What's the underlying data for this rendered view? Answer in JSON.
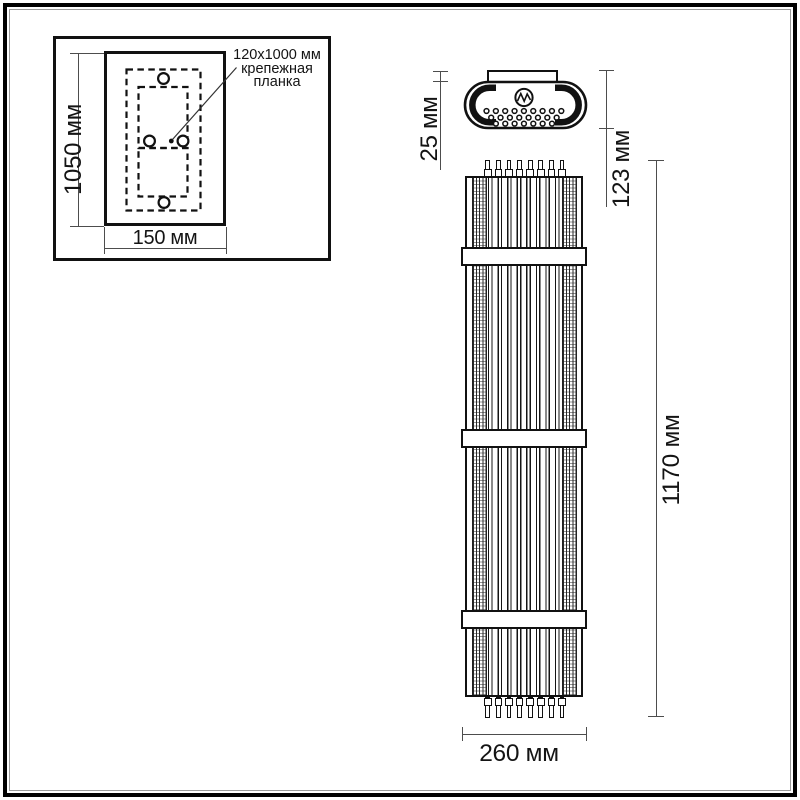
{
  "drawing": {
    "inset": {
      "callout_lines": [
        "120x1000 мм",
        "крепежная",
        "планка"
      ],
      "height_label": "1050 мм",
      "width_label": "150 мм"
    },
    "top_view": {
      "plate_depth_label": "25 мм",
      "total_depth_label": "123 мм",
      "perforation_rows": [
        9,
        8,
        7
      ]
    },
    "front_view": {
      "height_label": "1170 мм",
      "width_label": "260 мм",
      "rods_top": 8,
      "rods_bottom": 8
    }
  }
}
